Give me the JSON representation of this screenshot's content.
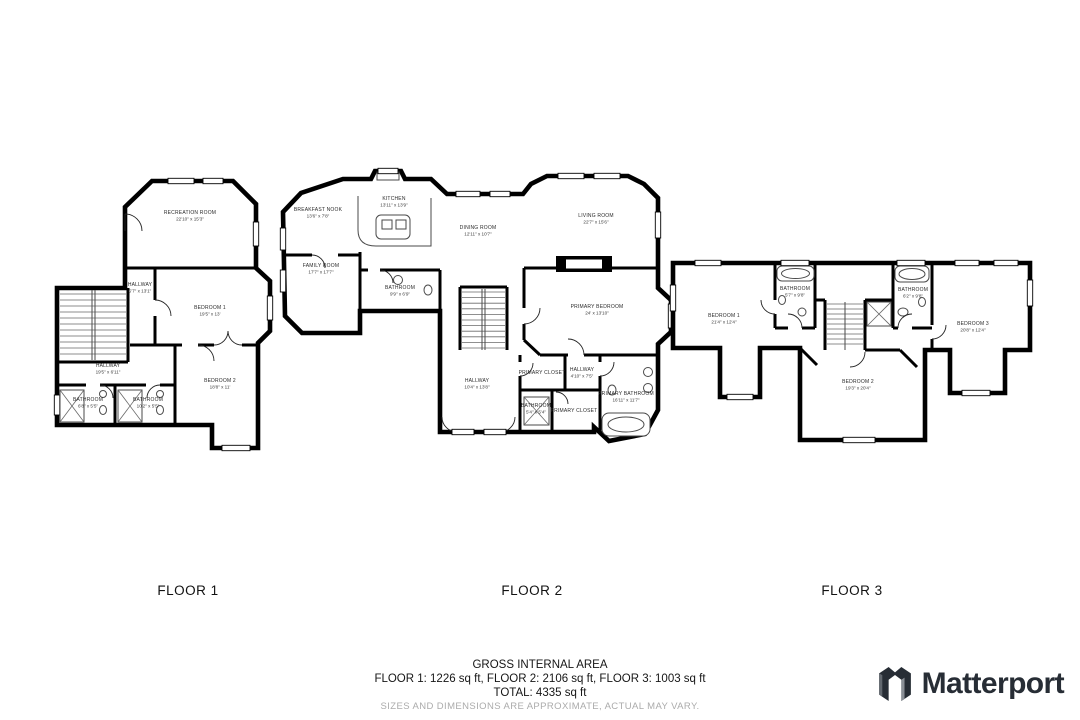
{
  "colors": {
    "wall": "#000000",
    "label_text": "#2b2b2b",
    "disclaimer_text": "#ababab",
    "brand_dark": "#272d35"
  },
  "floors": [
    {
      "label": "FLOOR 1",
      "rooms": [
        {
          "name": "RECREATION ROOM",
          "dims": "22'10\" x 15'3\""
        },
        {
          "name": "HALLWAY",
          "dims": "5'7\" x 13'1\""
        },
        {
          "name": "BEDROOM 1",
          "dims": "19'5\" x 13'"
        },
        {
          "name": "HALLWAY",
          "dims": "19'5\" x 6'11\""
        },
        {
          "name": "BATHROOM",
          "dims": "6'8\" x 5'5\""
        },
        {
          "name": "BATHROOM",
          "dims": "10'2\" x 5'5\""
        },
        {
          "name": "BEDROOM 2",
          "dims": "18'8\" x 11'"
        }
      ]
    },
    {
      "label": "FLOOR 2",
      "rooms": [
        {
          "name": "BREAKFAST NOOK",
          "dims": "13'6\" x 7'8\""
        },
        {
          "name": "KITCHEN",
          "dims": "13'11\" x 13'9\""
        },
        {
          "name": "DINING ROOM",
          "dims": "12'11\" x 10'7\""
        },
        {
          "name": "LIVING ROOM",
          "dims": "22'7\" x 15'6\""
        },
        {
          "name": "FAMILY ROOM",
          "dims": "17'7\" x 17'7\""
        },
        {
          "name": "BATHROOM",
          "dims": "9'9\" x 6'9\""
        },
        {
          "name": "PRIMARY BEDROOM",
          "dims": "24' x 13'10\""
        },
        {
          "name": "HALLWAY",
          "dims": "10'4\" x 13'8\""
        },
        {
          "name": "PRIMARY CLOSET",
          "dims": ""
        },
        {
          "name": "HALLWAY",
          "dims": "4'10\" x 7'5\""
        },
        {
          "name": "BATHROOM",
          "dims": "5'4\" x 5'4\""
        },
        {
          "name": "PRIMARY CLOSET",
          "dims": ""
        },
        {
          "name": "PRIMARY BATHROOM",
          "dims": "16'11\" x 11'7\""
        }
      ]
    },
    {
      "label": "FLOOR 3",
      "rooms": [
        {
          "name": "BEDROOM 1",
          "dims": "21'4\" x 12'4\""
        },
        {
          "name": "BATHROOM",
          "dims": "5'7\" x 9'8\""
        },
        {
          "name": "BATHROOM",
          "dims": "6'2\" x 9'8\""
        },
        {
          "name": "BEDROOM 3",
          "dims": "20'8\" x 12'4\""
        },
        {
          "name": "BEDROOM 2",
          "dims": "19'3\" x 20'4\""
        }
      ]
    }
  ],
  "footer": {
    "title": "GROSS INTERNAL AREA",
    "areas_line": "FLOOR 1: 1226 sq ft, FLOOR 2: 2106 sq ft, FLOOR 3: 1003 sq ft",
    "total_line": "TOTAL: 4335 sq ft",
    "disclaimer": "SIZES AND DIMENSIONS ARE APPROXIMATE, ACTUAL MAY VARY.",
    "brand": "Matterport"
  }
}
